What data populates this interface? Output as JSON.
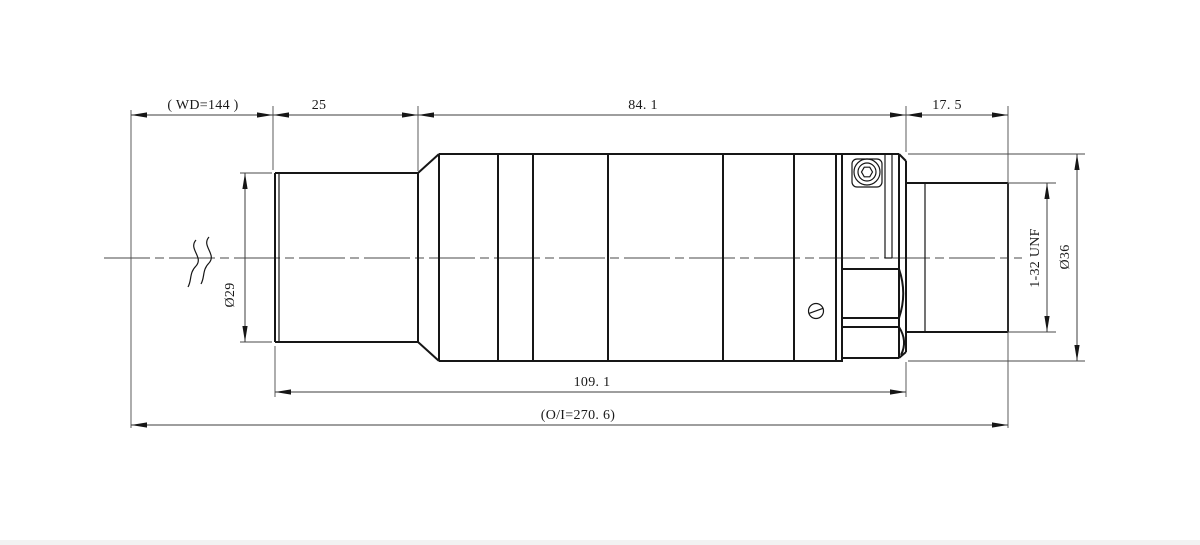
{
  "drawing_title": "lens-outline-mechanical-drawing",
  "colors": {
    "background": "#ffffff",
    "outline": "#161616",
    "dimension_lines": "#3d3d3d",
    "text": "#1a1a1a"
  },
  "dims": {
    "wd": "( WD=144 )",
    "front_length": "25",
    "body_length": "84. 1",
    "rear_length": "17. 5",
    "front_diameter": "Ø29",
    "thread": "1-32 UNF",
    "body_diameter": "Ø36",
    "front_body_length": "109. 1",
    "object_image_distance": "(O/I=270. 6)"
  }
}
